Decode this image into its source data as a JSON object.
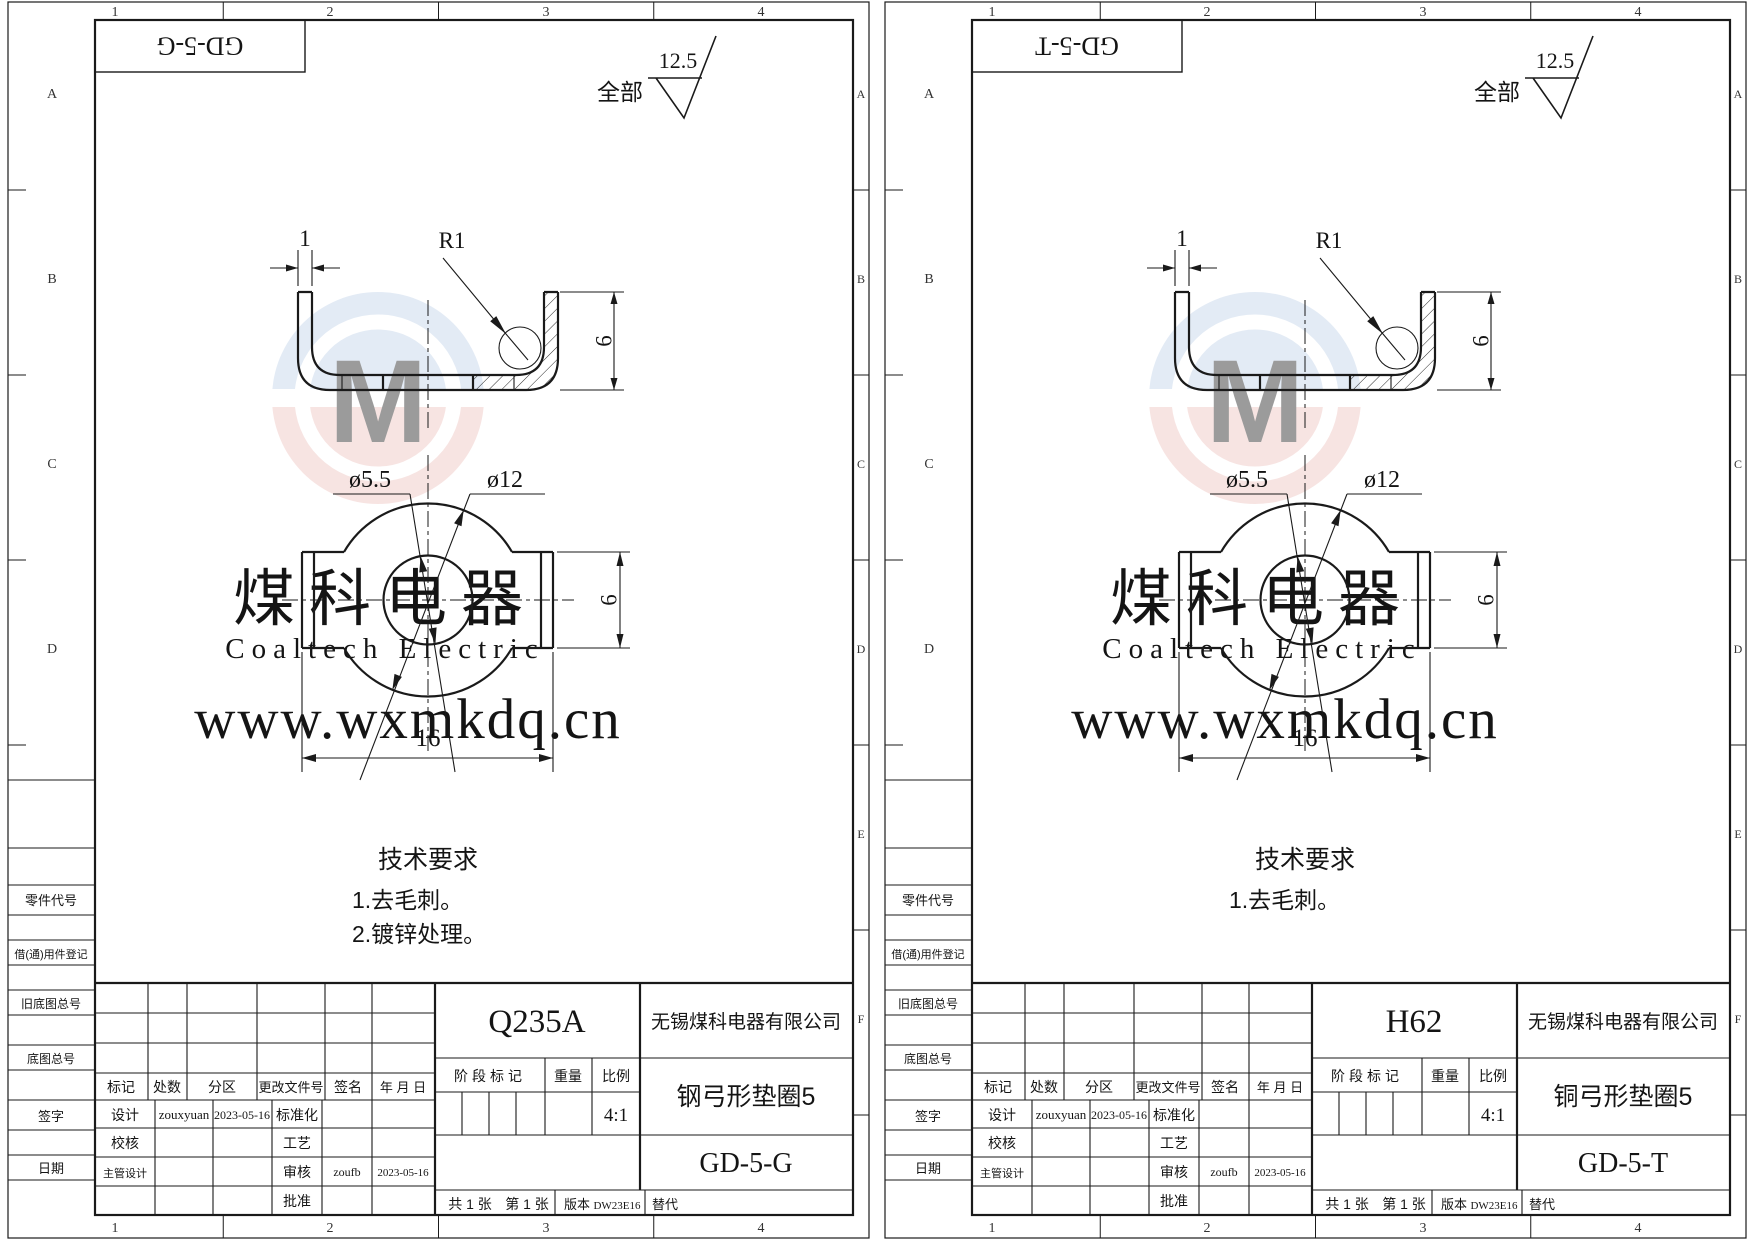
{
  "window": {
    "width": 1754,
    "height": 1240,
    "background": "#ffffff",
    "line_color": "#1a1a1a",
    "watermark_gray": "#d9d9d9",
    "logo_blue": "#bdd0e8",
    "logo_red": "#eec0bc"
  },
  "zones": {
    "cols": [
      "1",
      "2",
      "3",
      "4"
    ],
    "rows": [
      "A",
      "B",
      "C",
      "D",
      "E",
      "F"
    ]
  },
  "surface_finish": {
    "scope": "全部",
    "roughness": "12.5"
  },
  "dimensions": {
    "thickness": "1",
    "bend_radius": "R1",
    "section_height": "6",
    "hole_dia": "ø5.5",
    "outer_dia": "ø12",
    "overall_width": "16",
    "tab_height": "6"
  },
  "tech_requirements": {
    "title": "技术要求"
  },
  "watermark": {
    "brand_cn": "煤科电器",
    "brand_en": "Coaltech Electric",
    "url": "www.wxmkdq.cn",
    "logo_letter": "M"
  },
  "margin_labels": {
    "part_code": "零件代号",
    "borrow_reg": "借(通)用件登记",
    "old_base_no": "旧底图总号",
    "base_no": "底图总号",
    "signature": "签字",
    "date": "日期"
  },
  "title_block": {
    "rev_cols": [
      "标记",
      "处数",
      "分区",
      "更改文件号",
      "签名",
      "年 月 日"
    ],
    "roles": {
      "design": "设计",
      "check": "校核",
      "chief": "主管设计",
      "standard": "标准化",
      "process": "工艺",
      "audit": "审核",
      "approve": "批准"
    },
    "designer": "zouxyuan",
    "design_date": "2023-05-16",
    "auditor": "zoufb",
    "audit_date": "2023-05-16",
    "company": "无锡煤科电器有限公司",
    "stage_label": "阶段标记",
    "weight_label": "重量",
    "scale_label": "比例",
    "scale_value": "4:1",
    "sheet_count": "共 1 张",
    "sheet_no": "第 1 张",
    "version_label": "版本",
    "version_value": "DW23E16",
    "replace_label": "替代"
  },
  "sheets": [
    {
      "corner_code": "GD-5-G",
      "material": "Q235A",
      "part_name": "钢弓形垫圈5",
      "drawing_no": "GD-5-G",
      "tech_items": [
        "1.去毛刺。",
        "2.镀锌处理。"
      ]
    },
    {
      "corner_code": "GD-5-T",
      "material": "H62",
      "part_name": "铜弓形垫圈5",
      "drawing_no": "GD-5-T",
      "tech_items": [
        "1.去毛刺。"
      ]
    }
  ]
}
